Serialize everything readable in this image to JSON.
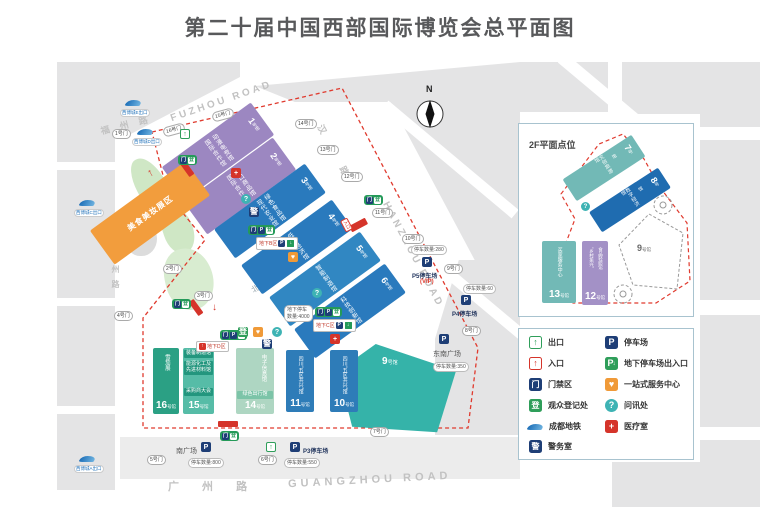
{
  "title": "第二十届中国西部国际博览会总平面图",
  "compass": "N",
  "icons": {
    "exit": "↑",
    "entrance": "↑",
    "gate": "门",
    "registration": "登",
    "police": "警",
    "parking": "P",
    "service": "♥",
    "info": "?",
    "medical": "+",
    "down_arrow": "↓",
    "up_arrow": "↑"
  },
  "roads": {
    "fuzhou_cn": "福 州 路",
    "fuzhou_en": "FUZHOU ROAD",
    "hanzhou_cn": "汉 州 路",
    "hanzhou_en": "HANZHOU ROAD",
    "guangzhou_cn": "广 州 路",
    "guangzhou_en": "GUANGZHOU ROAD",
    "shuzhou_cn": "蜀州路"
  },
  "halls": {
    "h1": {
      "num": "1",
      "suffix": "号馆",
      "names": [
        "国际合作馆",
        "动漫电竞馆"
      ]
    },
    "h2": {
      "num": "2",
      "suffix": "号馆",
      "names": [
        "国际合作馆",
        "进口商品馆"
      ]
    },
    "h3": {
      "num": "3",
      "suffix": "号馆",
      "names": [
        "现代农业馆",
        "绿色食品馆"
      ]
    },
    "h4": {
      "num": "4",
      "suffix": "号馆",
      "names": [
        "低空经济馆"
      ]
    },
    "h5": {
      "num": "5",
      "suffix": "号馆",
      "names": [
        "智能制造馆"
      ]
    },
    "h6": {
      "num": "6",
      "suffix": "号馆",
      "names": [
        "科技创新馆"
      ]
    },
    "h9": {
      "num": "9",
      "suffix": "号馆"
    },
    "h10": {
      "num": "10",
      "suffix": "号馆",
      "name": "四川“五区共兴”馆"
    },
    "h11": {
      "num": "11",
      "suffix": "号馆",
      "name": "四川“五区共兴”馆"
    },
    "h14": {
      "num": "14",
      "suffix": "号馆",
      "name": "电子信息馆",
      "sub": "绿色出行馆"
    },
    "h15": {
      "num": "15",
      "suffix": "号馆",
      "subs": [
        "装备制造馆",
        "能源化工及先进材料馆",
        "采购商大会"
      ]
    },
    "h16": {
      "num": "16",
      "suffix": "号馆",
      "name": "雪茄展"
    }
  },
  "zones": {
    "orange": "美食美妆展区",
    "north_plaza": "北广场",
    "southeast_plaza": "东南广场",
    "south_plaza": "南广场"
  },
  "parking": {
    "p5": {
      "label": "P5停车场",
      "vip": "(VIP)",
      "count": "停车数量:280"
    },
    "p4": {
      "label": "P4停车场",
      "count": "停车数量:60"
    },
    "p3": {
      "label": "P3停车场",
      "count": "停车数量:550"
    },
    "south": {
      "count": "停车数量:800"
    },
    "southeast": {
      "count": "停车数量:350"
    }
  },
  "underground": {
    "b": "地下B区",
    "c": "地下C区",
    "d": "地下D区",
    "note_line1": "地下停车",
    "note_line2": "数量:4000"
  },
  "entrance_label": "入口",
  "gates": {
    "g1": "1号门",
    "g2": "2号门",
    "g3": "3号门",
    "g4": "4号门",
    "g5": "5号门",
    "g6": "6号门",
    "g7": "7号门",
    "g8": "8号门",
    "g9": "9号门",
    "g10": "10号门",
    "g11": "11号门",
    "g12": "12号门",
    "g13": "13号门",
    "g14": "14号门",
    "g15": "15号门",
    "g16": "16号门"
  },
  "metro": {
    "e": "西博城E出口",
    "d": "西博城D出口",
    "c": "西博城C出口",
    "a": "西博城A出口"
  },
  "inset": {
    "title": "2F平面点位",
    "h7": {
      "num": "7",
      "suffix": "号馆",
      "name": "文创旅游馆"
    },
    "h8": {
      "num": "8",
      "suffix": "号馆",
      "name": "数字经济馆"
    },
    "h9": {
      "num": "9",
      "suffix": "号馆"
    },
    "h12": {
      "num": "12",
      "suffix": "号馆",
      "names": [
        "“乡村振兴”",
        "食品轻纺馆"
      ]
    },
    "h13": {
      "num": "13",
      "suffix": "号馆",
      "name": "买家服务中心"
    }
  },
  "legend": {
    "left": [
      {
        "icon": "exit",
        "label": "出口"
      },
      {
        "icon": "entrance",
        "label": "入口"
      },
      {
        "icon": "gate",
        "label": "门禁区"
      },
      {
        "icon": "registration",
        "label": "观众登记处"
      },
      {
        "icon": "metro",
        "label": "成都地铁"
      },
      {
        "icon": "police",
        "label": "警务室"
      }
    ],
    "right": [
      {
        "icon": "parking",
        "label": "停车场"
      },
      {
        "icon": "underground_parking",
        "label": "地下停车场出入口"
      },
      {
        "icon": "service",
        "label": "一站式服务中心"
      },
      {
        "icon": "info",
        "label": "问讯处"
      },
      {
        "icon": "medical",
        "label": "医疗室"
      }
    ]
  }
}
